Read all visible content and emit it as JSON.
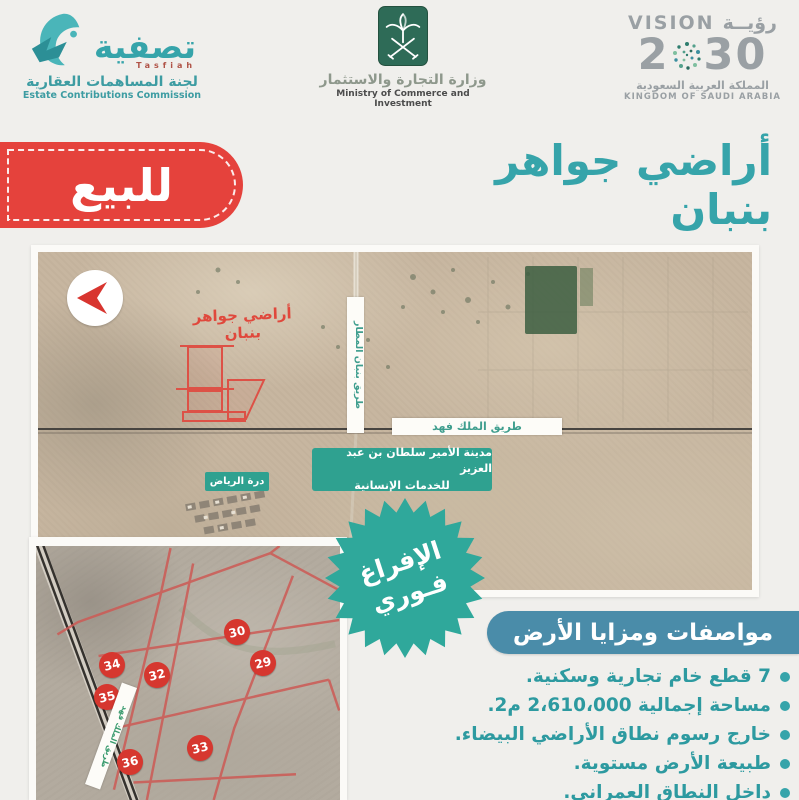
{
  "header": {
    "tasfiah": {
      "brand_ar": "تصفية",
      "brand_en": "Tasfiah",
      "commission_ar": "لجنة المساهمات العقارية",
      "commission_en": "Estate Contributions Commission"
    },
    "ministry": {
      "name_ar": "وزارة التجارة والاستثمار",
      "name_en": "Ministry of Commerce and Investment"
    },
    "vision": {
      "word_en": "VISION",
      "word_ar": "رؤيــة",
      "year_prefix": "2",
      "year_suffix": "30",
      "country_ar": "المملكة العربية السعودية",
      "country_en": "KINGDOM OF SAUDI ARABIA"
    }
  },
  "title": {
    "for_sale_badge": "للبيع",
    "text": "أراضي جواهر بنبان"
  },
  "main_map": {
    "area_label": "أراضي جواهر بنبان",
    "road_vertical": "طريق بنبان المطار",
    "road_horizontal": "طريق الملك فهد",
    "city_label_line1": "مدينة الأمير سلطان بن عبد العزيز",
    "city_label_line2": "للخدمات الإنسانية",
    "durrat_label": "درة الرياض"
  },
  "plots_map": {
    "road_label": "طريق الملك فهد",
    "plots": [
      {
        "num": "30"
      },
      {
        "num": "29"
      },
      {
        "num": "34"
      },
      {
        "num": "32"
      },
      {
        "num": "35"
      },
      {
        "num": "33"
      },
      {
        "num": "36"
      }
    ]
  },
  "ribbon": {
    "line1": "الإفراغ",
    "line2": "فـوري"
  },
  "specs": {
    "heading": "مواصفات ومزايا الأرض",
    "bullets": [
      "7 قطع خام تجارية وسكنية.",
      "مساحة إجمالية 2،610،000 م2.",
      "خارج رسوم نطاق الأراضي البيضاء.",
      "طبيعة الأرض مستوية.",
      "داخل النطاق العمراني."
    ]
  },
  "colors": {
    "accent_teal": "#36a4aa",
    "badge_red": "#e5423c",
    "specs_header_bg": "#4a8ca9",
    "starburst_teal": "#2fa89b",
    "map_label_teal": "#2fa190",
    "plot_circle_red": "#d6372f",
    "plot_outline_red": "#dd5146",
    "ministry_green": "#2e6b57",
    "vision_gray": "#9aa0a4"
  }
}
